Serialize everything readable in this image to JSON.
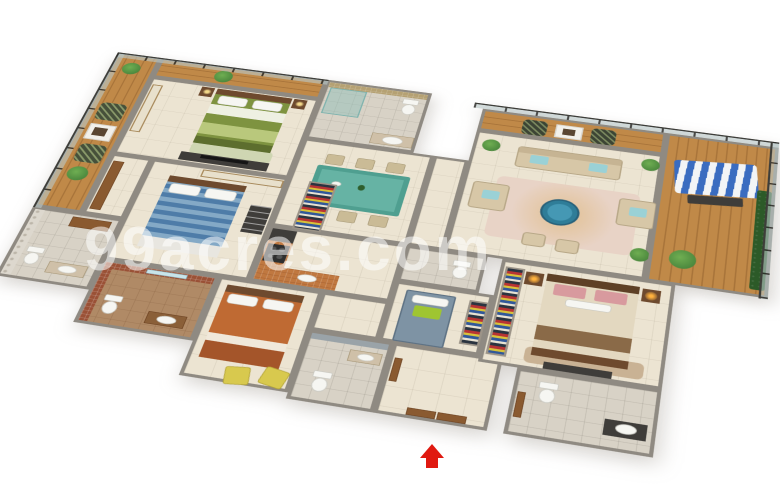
{
  "watermark": {
    "text": "99acres.com"
  },
  "palette": {
    "wall": "#8f8a82",
    "floor": "#ece4d2",
    "floorBath": "#d8d2c6",
    "floorBath3": "#b08a66",
    "wood": "#c08948",
    "woodDark": "#a8743a",
    "glass": "#b9c8c899",
    "mosaicRed": "#9a5136",
    "mosaicTan": "#b5a173",
    "wallDeco": "#ddd8ce",
    "counter": "#c07840",
    "fixture": "#f6f6f2",
    "door": "#8a5a30",
    "plant": "#3f7a36",
    "plantLight": "#6fae52",
    "sofa": "#d7c7a7",
    "chair": "#cabb96",
    "pillowBlue": "#9ad1d6",
    "darkFurn": "#3f3d3a",
    "tableTeal": "#4f9f90",
    "tableTealGlass": "#66b3a4",
    "roundTable": "#2f7d98",
    "rugPink": "#e8d3c6",
    "rugGreen": "#cfd6b2",
    "bedGreen": "#7e9340",
    "bedGreenThrow": "#b9c87c",
    "bedBlue": "#4e7ca8",
    "bedBlueLight": "#84a9c6",
    "bedOrange": "#bf6a33",
    "bedCream": "#e3d8c0",
    "pillowPink": "#d89a9e",
    "bedGray": "#7e93a4",
    "cushionGreen": "#9fc531",
    "chairYellow": "#d8c94e",
    "headboard": "#6e4a2e",
    "wardrobe": "#e8e0cc",
    "swingBlue": "#3a6cc0",
    "hedge": "#2c5a28",
    "lampGlow": "#ffb23e",
    "lampCool": "#f3d98a",
    "arrow": "#e01910"
  },
  "scene": {
    "type": "3d-isometric-floorplan-render",
    "rooms": [
      {
        "id": "deck-west",
        "items": [
          "patterned-chairs",
          "planter-table",
          "plants",
          "glass-railing"
        ]
      },
      {
        "id": "bedroom-1",
        "items": [
          "green-double-bed",
          "wardrobe",
          "nightstands-with-lamps",
          "tv-unit"
        ]
      },
      {
        "id": "bathroom-1",
        "items": [
          "glass-shower",
          "toilet",
          "wash-basin"
        ]
      },
      {
        "id": "dining-hall",
        "items": [
          "teal-dining-table",
          "six-chairs"
        ]
      },
      {
        "id": "living-room",
        "items": [
          "three-seat-sofa",
          "two-armchairs",
          "round-blue-table",
          "pink-rug",
          "ottomans",
          "plants"
        ]
      },
      {
        "id": "living-deck",
        "items": [
          "two-dark-chairs",
          "frame-table"
        ]
      },
      {
        "id": "balcony-east",
        "items": [
          "striped-swing",
          "hedge",
          "plant",
          "glass-railing"
        ]
      },
      {
        "id": "bathroom-2",
        "items": [
          "toilet",
          "wash-basin",
          "cabinet"
        ]
      },
      {
        "id": "bedroom-2",
        "items": [
          "blue-striped-bed",
          "wardrobe",
          "luggage-bench"
        ]
      },
      {
        "id": "bathroom-3",
        "items": [
          "toilet",
          "wash-basin",
          "red-mosaic-walls"
        ]
      },
      {
        "id": "bedroom-3",
        "items": [
          "orange-bed",
          "yellow-armchairs"
        ]
      },
      {
        "id": "kitchen",
        "items": [
          "l-shaped-orange-counter",
          "stove",
          "fridge"
        ]
      },
      {
        "id": "utility-room",
        "items": [
          "gray-single-bed",
          "green-cushion"
        ]
      },
      {
        "id": "utility-bath",
        "items": [
          "toilet"
        ]
      },
      {
        "id": "master-bedroom",
        "items": [
          "cream-bed-pink-pillows",
          "lit-lamps",
          "colorful-wardrobe",
          "bench"
        ]
      },
      {
        "id": "master-bathroom",
        "items": [
          "toilet",
          "dark-vanity-basin"
        ]
      },
      {
        "id": "entrance-foyer",
        "items": [
          "wooden-double-door"
        ]
      },
      {
        "id": "entrance-bathroom",
        "items": [
          "toilet",
          "basin"
        ]
      },
      {
        "id": "entrance-arrow",
        "items": [
          "red-up-arrow"
        ]
      }
    ]
  }
}
